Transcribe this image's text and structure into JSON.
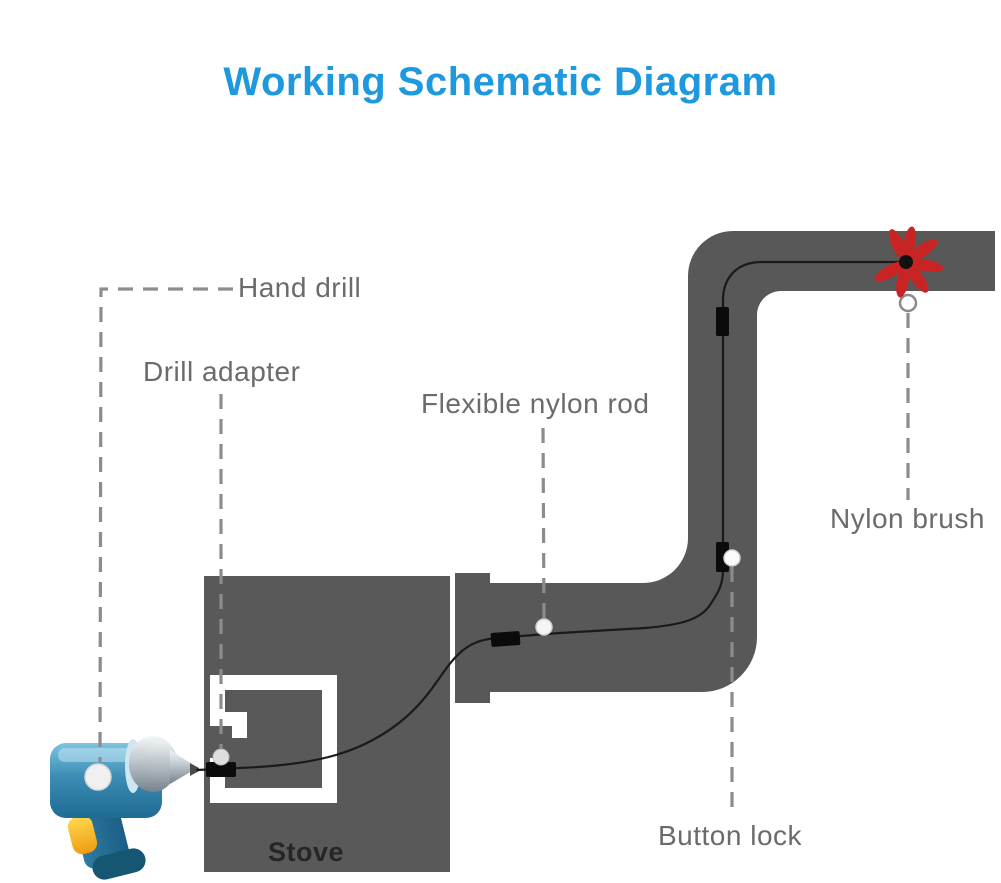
{
  "title": {
    "text": "Working Schematic Diagram"
  },
  "labels": {
    "hand_drill": "Hand drill",
    "drill_adapter": "Drill adapter",
    "flexible_nylon_rod": "Flexible nylon rod",
    "nylon_brush": "Nylon brush",
    "button_lock": "Button lock",
    "stove": "Stove"
  },
  "colors": {
    "title_blue": "#1e98de",
    "label_gray": "#6b6b6b",
    "stove_text": "#262626",
    "pipe_gray": "#585858",
    "stove_gray": "#595959",
    "brush_red": "#c92424",
    "rod_black": "#1a1a1a",
    "leader_gray": "#8c8c8c",
    "drill_blue": "#3b8cb4",
    "trigger_yellow": "#f2a51a"
  }
}
